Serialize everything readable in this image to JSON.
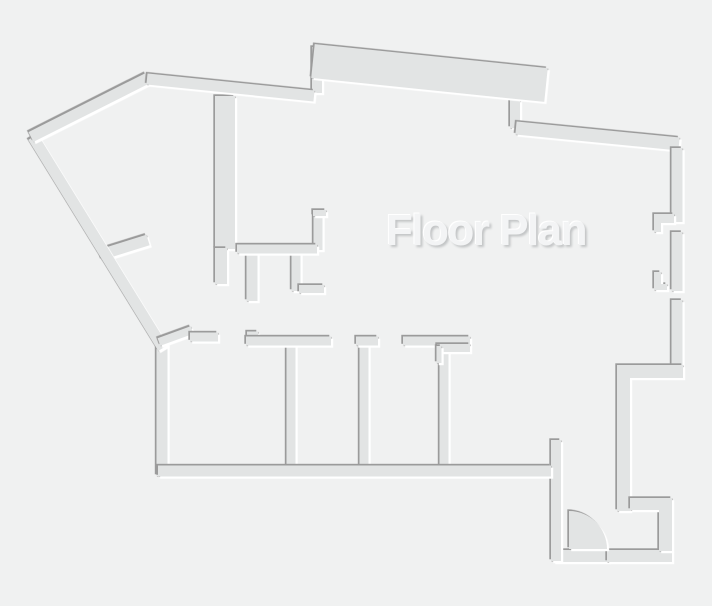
{
  "title": {
    "label": "Floor Plan"
  },
  "canvas": {
    "width": 712,
    "height": 606
  },
  "colors": {
    "background": "#f0f1f1",
    "wall_fill": "#e2e4e4",
    "edge_dark": "#9b9b9b",
    "edge_light": "#ffffff",
    "title_fill": "#f3f4f5",
    "title_shadow": "#c3c5c6",
    "title_highlight": "#ffffff"
  },
  "floorplan": {
    "wall_lines": [
      {
        "name": "hall-wall-vertical-main",
        "x1": 225,
        "y1": 96,
        "x2": 225,
        "y2": 249,
        "w": 20
      },
      {
        "name": "hall-wall-vertical-lower",
        "x1": 221,
        "y1": 248,
        "x2": 221,
        "y2": 284,
        "w": 12
      },
      {
        "name": "closet-stub-left",
        "x1": 252,
        "y1": 252,
        "x2": 252,
        "y2": 301,
        "w": 11
      },
      {
        "name": "closet-stub-right",
        "x1": 296,
        "y1": 252,
        "x2": 296,
        "y2": 291,
        "w": 9
      },
      {
        "name": "entry-threshold",
        "x1": 553,
        "y1": 556,
        "x2": 609,
        "y2": 556,
        "w": 12
      },
      {
        "name": "room-divider-1",
        "x1": 291,
        "y1": 344,
        "x2": 291,
        "y2": 467,
        "w": 9
      },
      {
        "name": "room-divider-2",
        "x1": 364,
        "y1": 340,
        "x2": 364,
        "y2": 467,
        "w": 9
      },
      {
        "name": "room-divider-3",
        "x1": 444,
        "y1": 350,
        "x2": 444,
        "y2": 467,
        "w": 9
      },
      {
        "name": "hall-corner-vertical",
        "x1": 318,
        "y1": 212,
        "x2": 318,
        "y2": 250,
        "w": 9
      },
      {
        "name": "hall-corner-cap",
        "x1": 313,
        "y1": 213,
        "x2": 326,
        "y2": 213,
        "w": 6
      },
      {
        "name": "bay-left-edge",
        "x1": 317,
        "y1": 47,
        "x2": 317,
        "y2": 93,
        "w": 10
      },
      {
        "name": "bay-step",
        "x1": 515,
        "y1": 100,
        "x2": 515,
        "y2": 128,
        "w": 10
      },
      {
        "name": "vestibule-left-wall",
        "x1": 556,
        "y1": 440,
        "x2": 556,
        "y2": 561,
        "w": 10
      },
      {
        "name": "door-gap-stub",
        "x1": 100,
        "y1": 255,
        "x2": 148,
        "y2": 240,
        "w": 11
      },
      {
        "name": "left-wall-vertical",
        "x1": 162,
        "y1": 343,
        "x2": 162,
        "y2": 476,
        "w": 11
      },
      {
        "name": "left-wall-diagonal",
        "x1": 33,
        "y1": 137,
        "x2": 163,
        "y2": 348,
        "w": 11
      },
      {
        "name": "apex-wall",
        "x1": 31,
        "y1": 137,
        "x2": 148,
        "y2": 78,
        "w": 11
      },
      {
        "name": "top-wall-left",
        "x1": 147,
        "y1": 79,
        "x2": 314,
        "y2": 96,
        "w": 11
      },
      {
        "name": "bay-slab",
        "x1": 313,
        "y1": 61,
        "x2": 546,
        "y2": 85,
        "w": 34
      },
      {
        "name": "top-wall-right",
        "x1": 516,
        "y1": 128,
        "x2": 679,
        "y2": 144,
        "w": 13
      },
      {
        "name": "hall-wall-horizontal",
        "x1": 237,
        "y1": 249,
        "x2": 317,
        "y2": 249,
        "w": 9
      },
      {
        "name": "closet-foot",
        "x1": 299,
        "y1": 289,
        "x2": 324,
        "y2": 289,
        "w": 8
      },
      {
        "name": "room-top-diagonal",
        "x1": 159,
        "y1": 342,
        "x2": 192,
        "y2": 330,
        "w": 8
      },
      {
        "name": "room-top-left",
        "x1": 190,
        "y1": 337,
        "x2": 218,
        "y2": 337,
        "w": 9
      },
      {
        "name": "room-top-jamb",
        "x1": 247,
        "y1": 336,
        "x2": 258,
        "y2": 336,
        "w": 9
      },
      {
        "name": "room-top-seg1",
        "x1": 246,
        "y1": 341,
        "x2": 331,
        "y2": 341,
        "w": 9
      },
      {
        "name": "divider2-cap",
        "x1": 356,
        "y1": 341,
        "x2": 378,
        "y2": 341,
        "w": 9
      },
      {
        "name": "room-top-seg3",
        "x1": 403,
        "y1": 341,
        "x2": 470,
        "y2": 341,
        "w": 9
      },
      {
        "name": "room-top-seg3-thick",
        "x1": 437,
        "y1": 348,
        "x2": 470,
        "y2": 348,
        "w": 8
      },
      {
        "name": "room-top-seg3-stub",
        "x1": 439,
        "y1": 346,
        "x2": 439,
        "y2": 363,
        "w": 5
      },
      {
        "name": "bottom-wall",
        "x1": 158,
        "y1": 471,
        "x2": 551,
        "y2": 471,
        "w": 11
      },
      {
        "name": "vestibule-bottom-wall",
        "x1": 607,
        "y1": 556,
        "x2": 672,
        "y2": 556,
        "w": 12
      },
      {
        "name": "right-wall-upper",
        "x1": 677,
        "y1": 148,
        "x2": 677,
        "y2": 222,
        "w": 11
      },
      {
        "name": "right-wall-middle",
        "x1": 677,
        "y1": 232,
        "x2": 677,
        "y2": 291,
        "w": 11
      },
      {
        "name": "right-wall-lower",
        "x1": 677,
        "y1": 300,
        "x2": 677,
        "y2": 371,
        "w": 11
      }
    ],
    "wall_paths": [
      {
        "name": "right-wall-jog",
        "d": "M617,365 H683 V378 H630 V511 H617 Z"
      },
      {
        "name": "entry-step",
        "d": "M630,498 H672 V551 H659 V510 H630 Z"
      },
      {
        "name": "window-jamb-upper",
        "d": "M654,214 H674 V223 H661 V232 H654 Z"
      },
      {
        "name": "window-jamb-lower",
        "d": "M654,272 H661 V284 H667 V290 H654 Z"
      }
    ],
    "door_arc": {
      "name": "entry-door-swing",
      "d": "M569,549 L569,511 A38,38 0 0 1 607,549 Z"
    }
  }
}
